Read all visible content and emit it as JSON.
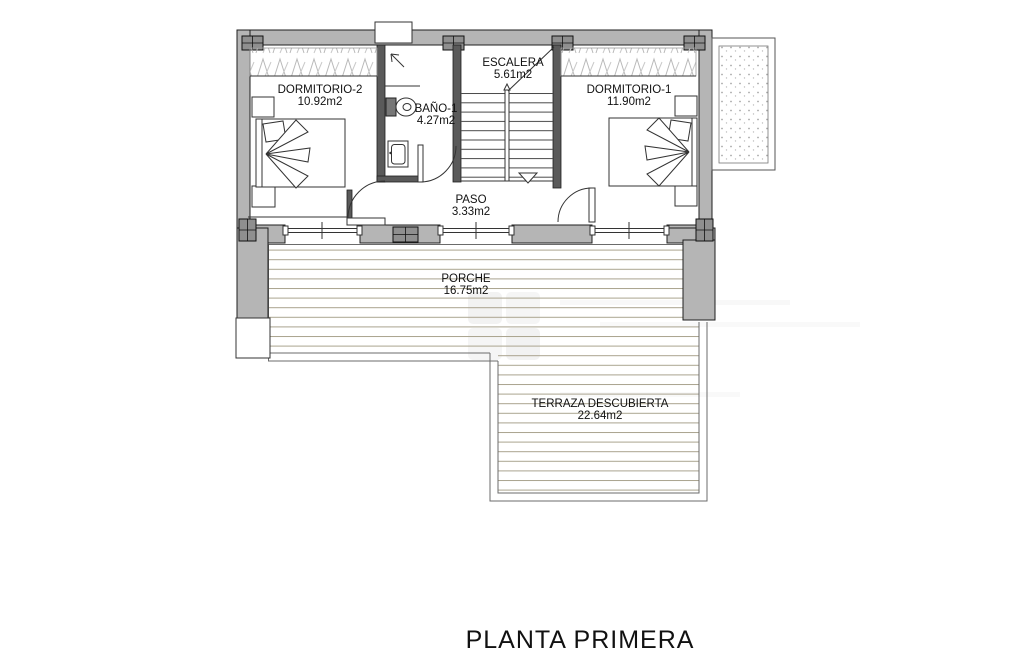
{
  "title": "PLANTA PRIMERA",
  "plan": {
    "type": "architectural-floor-plan",
    "rooms": [
      {
        "name": "DORMITORIO-2",
        "area": "10.92m2"
      },
      {
        "name": "BAÑO-1",
        "area": "4.27m2"
      },
      {
        "name": "ESCALERA",
        "area": "5.61m2"
      },
      {
        "name": "DORMITORIO-1",
        "area": "11.90m2"
      },
      {
        "name": "PASO",
        "area": "3.33m2"
      },
      {
        "name": "PORCHE",
        "area": "16.75m2"
      },
      {
        "name": "TERRAZA DESCUBIERTA",
        "area": "22.64m2"
      }
    ]
  },
  "colors": {
    "wall_gray": "#b5b5b5",
    "interior_wall": "#5a5a5a",
    "column_gray": "#8f8f8f",
    "deck_line": "#aaa38e",
    "outline": "#1f1f1f",
    "text": "#111111",
    "background": "#ffffff"
  }
}
